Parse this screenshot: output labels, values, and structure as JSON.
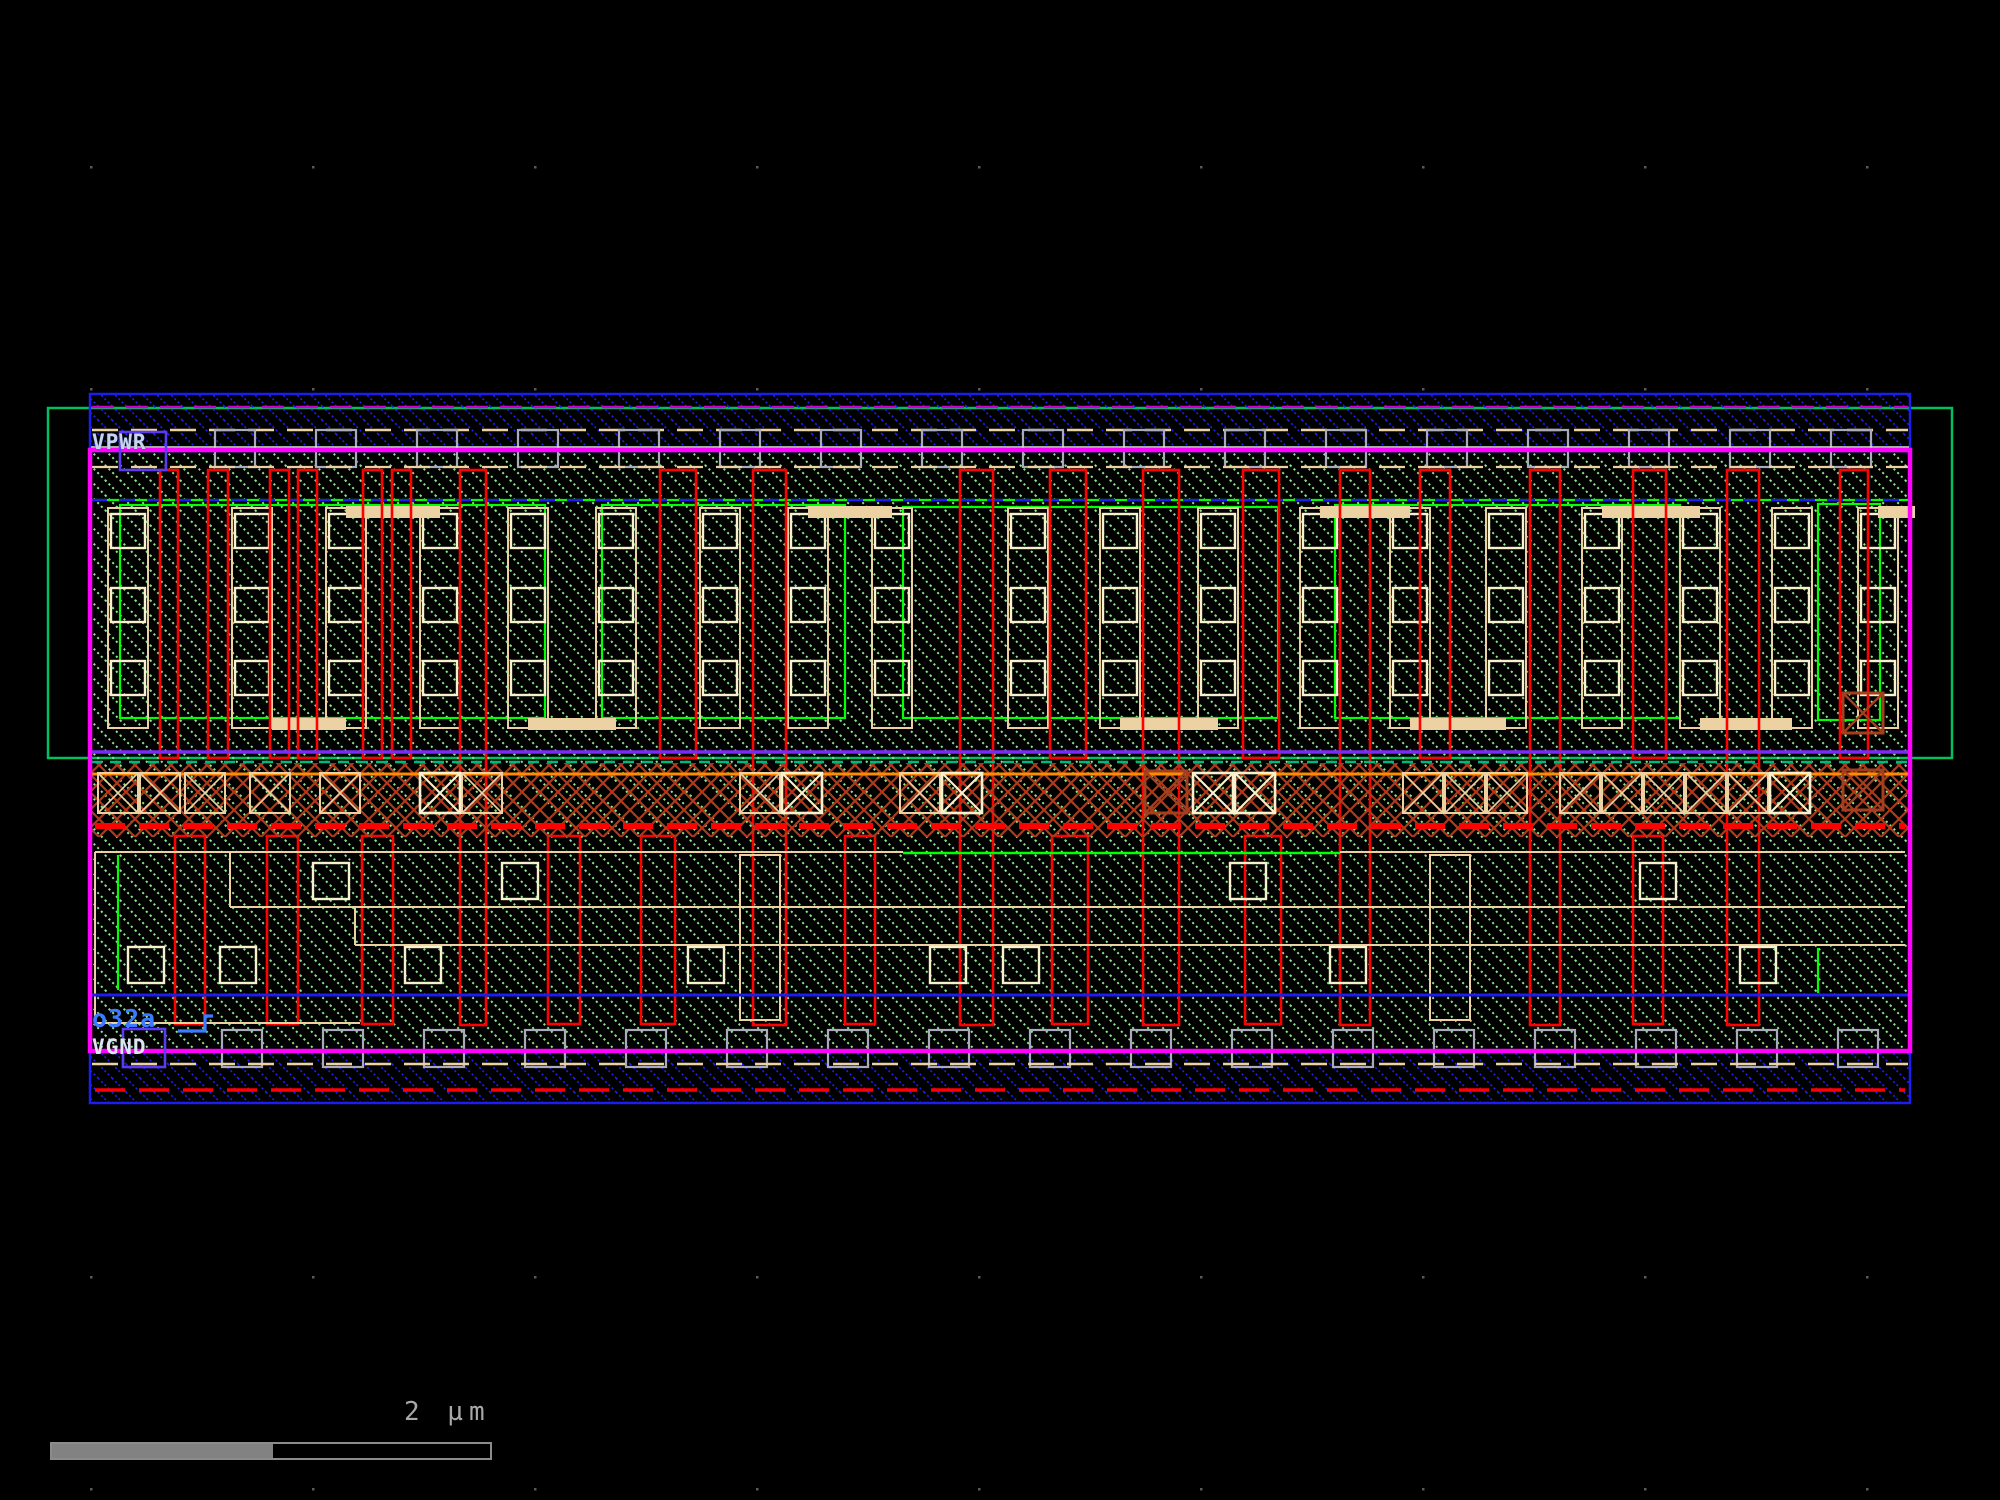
{
  "app": {
    "description": "IC layout viewer canvas (standard cell view)",
    "background": "#000000"
  },
  "labels": {
    "vpwr": "VPWR",
    "vgnd": "VGND",
    "cell_name": "o32a"
  },
  "scale_bar": {
    "label": "2 µm"
  },
  "palette": {
    "metal1_blue": "#1d1df2",
    "metal1_dash_magenta": "#cc00cc",
    "cell_border_magenta": "#ff00ff",
    "nwell_green": "#00c060",
    "pdiff_green": "#00ff00",
    "diffusion_dot_green": "#8ce88c",
    "poly_red": "#ff0000",
    "li_tan": "#ecd2a2",
    "contact_bright": "#f7f2cd",
    "mcon_gray": "#a9aabb",
    "band_brown": "#a33f1f",
    "band_red": "#d42808",
    "band_orange": "#ff8c00",
    "select_purple": "#7b2bf5",
    "tap_teal": "#00b87a",
    "port_box_violet": "#5a3bf0",
    "net_blue": "#3b7bff",
    "grid_dot_gray": "#5a5a5a",
    "scalebar_gray": "#8c8c8c",
    "rail_white_line": "#d8e8d8"
  }
}
